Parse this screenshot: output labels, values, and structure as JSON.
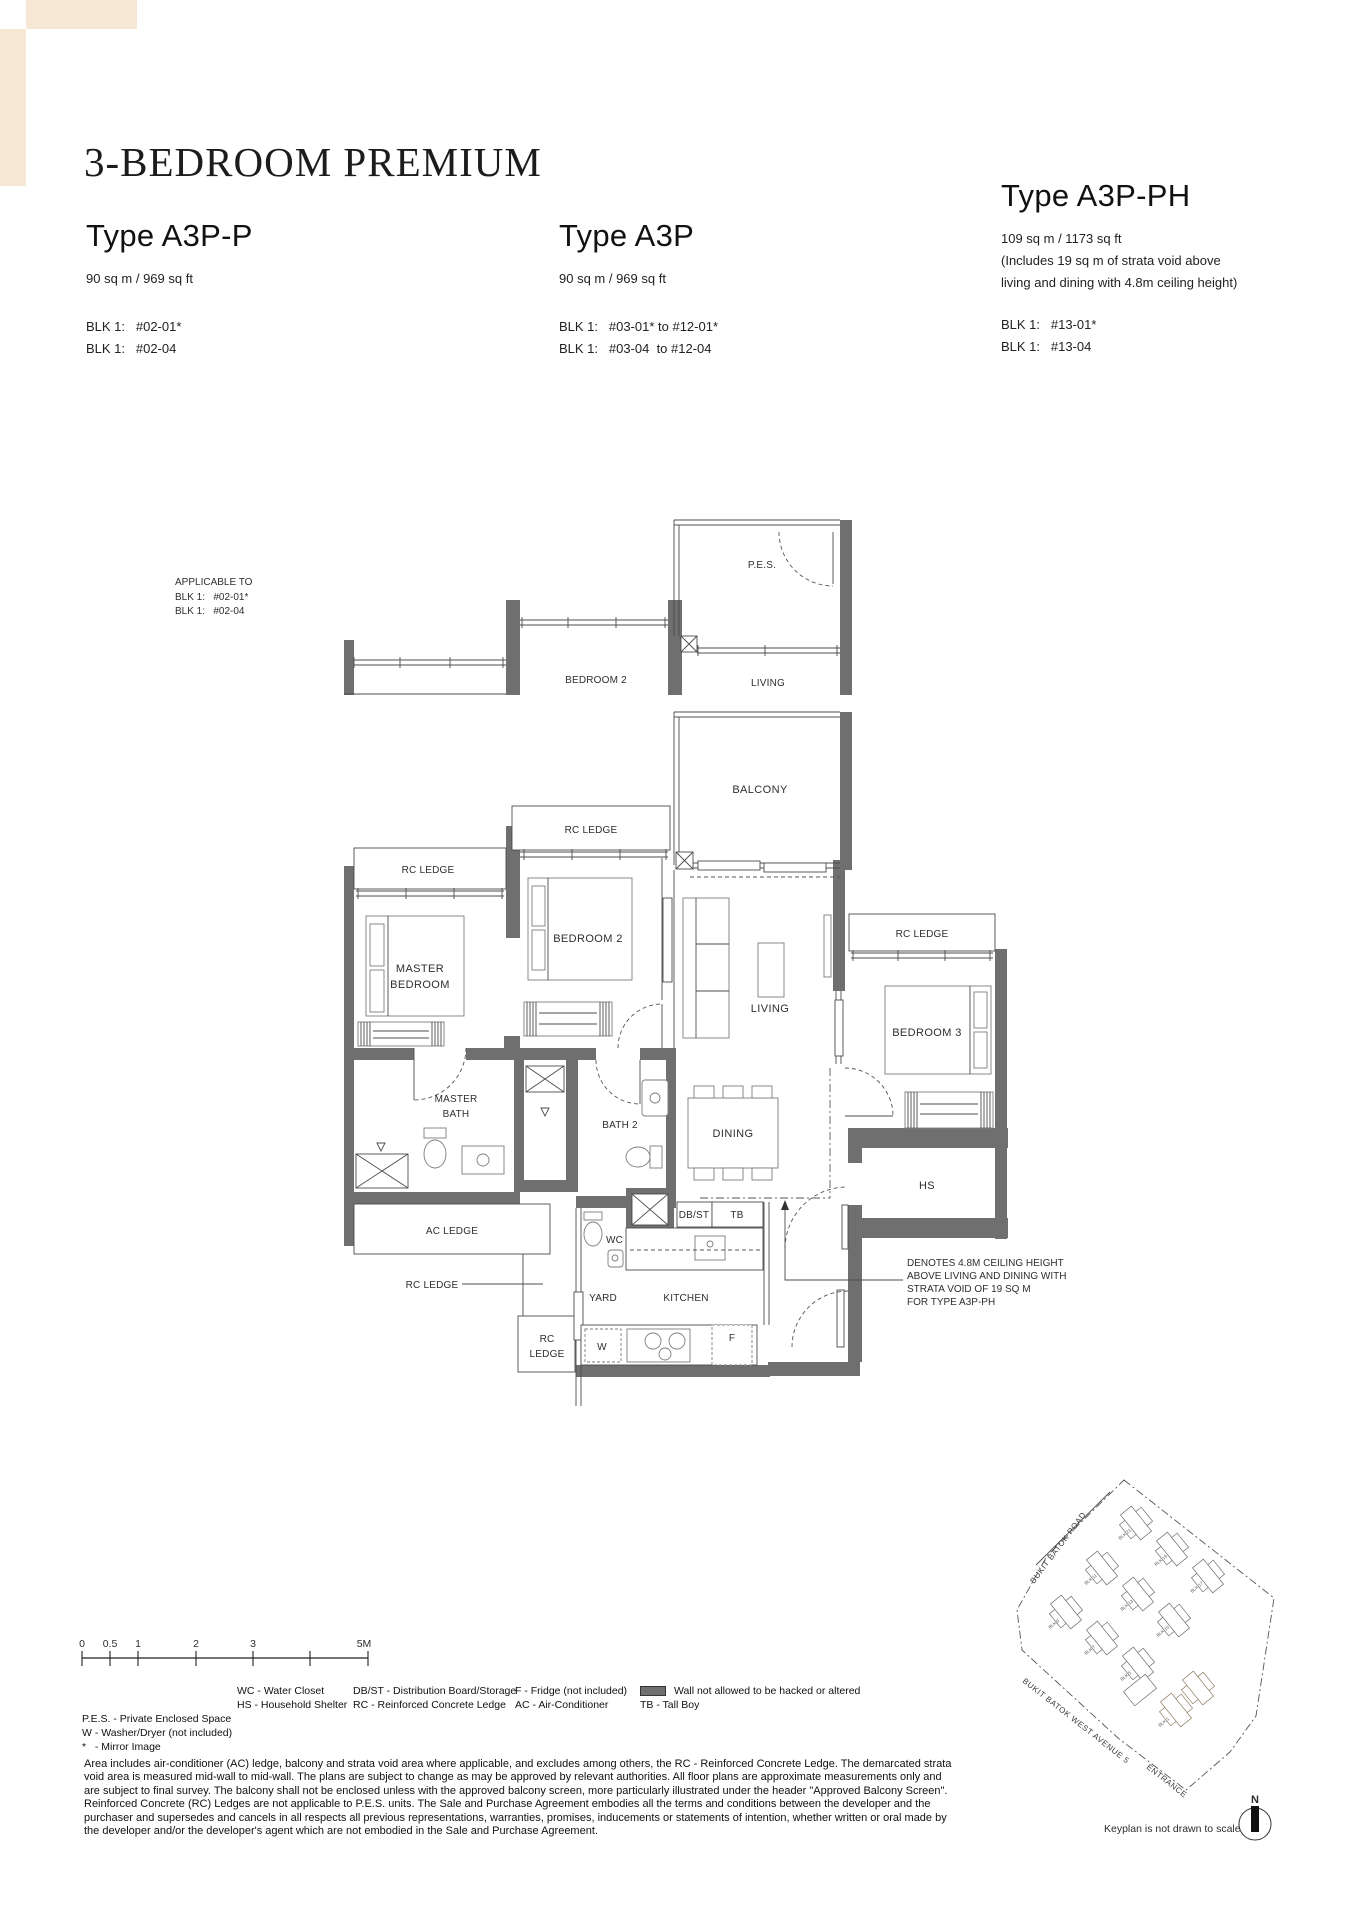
{
  "header": {
    "title": "3-BEDROOM PREMIUM"
  },
  "decor": {
    "beige": "#f5e7d4"
  },
  "types": [
    {
      "name": "Type A3P-P",
      "area": "90 sq m / 969 sq ft",
      "note_lines": [],
      "units": [
        "BLK 1:   #02-01*",
        "BLK 1:   #02-04"
      ]
    },
    {
      "name": "Type A3P",
      "area": "90 sq m / 969 sq ft",
      "note_lines": [],
      "units": [
        "BLK 1:   #03-01* to #12-01*",
        "BLK 1:   #03-04  to #12-04"
      ]
    },
    {
      "name": "Type A3P-PH",
      "area": "109 sq m / 1173 sq ft",
      "note_lines": [
        "(Includes 19 sq m of strata void above",
        "living and dining with 4.8m ceiling height)"
      ],
      "units": [
        "BLK 1:   #13-01*",
        "BLK 1:   #13-04"
      ]
    }
  ],
  "plan": {
    "applicable_note": [
      "APPLICABLE TO",
      "BLK 1:   #02-01*",
      "BLK 1:   #02-04"
    ],
    "labels": {
      "pes": "P.E.S.",
      "living": "LIVING",
      "bedroom2": "BEDROOM 2",
      "balcony": "BALCONY",
      "rc_ledge": "RC LEDGE",
      "rc_box_1": "RC",
      "rc_box_2": "LEDGE",
      "master_1": "MASTER",
      "master_2": "BEDROOM",
      "bedroom3": "BEDROOM 3",
      "dining": "DINING",
      "mbath_1": "MASTER",
      "mbath_2": "BATH",
      "bath2": "BATH 2",
      "hs": "HS",
      "ac_ledge": "AC LEDGE",
      "wc": "WC",
      "dbst": "DB/ST",
      "tb": "TB",
      "yard": "YARD",
      "kitchen": "KITCHEN",
      "w": "W",
      "f": "F"
    },
    "denote_note": [
      "DENOTES 4.8M CEILING HEIGHT",
      "ABOVE LIVING AND DINING WITH",
      "STRATA VOID OF 19 SQ M",
      "FOR TYPE A3P-PH"
    ]
  },
  "scalebar": {
    "labels": [
      "0",
      "0.5",
      "1",
      "2",
      "3",
      "5M"
    ]
  },
  "legend": {
    "col1": [
      "P.E.S. - Private Enclosed Space",
      "W - Washer/Dryer (not included)",
      "*   - Mirror Image"
    ],
    "col2": [
      "WC - Water Closet",
      "HS - Household Shelter"
    ],
    "col3": [
      "DB/ST - Distribution Board/Storage",
      "RC - Reinforced Concrete Ledge"
    ],
    "col4": [
      "F - Fridge (not included)",
      "AC - Air-Conditioner"
    ],
    "wall_item": "Wall not allowed to be hacked or altered",
    "tb_item": "TB - Tall Boy",
    "wall_color": "#6f6f6f"
  },
  "disclaimer_lines": [
    "Area includes air-conditioner (AC) ledge, balcony and strata void area where applicable, and excludes among others, the RC - Reinforced Concrete Ledge. The demarcated strata",
    "void area is measured mid-wall to mid-wall. The plans are subject to change as may be approved by relevant authorities. All floor plans are approximate measurements only and",
    "are subject to final survey. The balcony shall not be enclosed unless with the approved balcony screen, more particularly illustrated under the header \"Approved Balcony Screen\".",
    "Reinforced Concrete (RC) Ledges are not applicable to P.E.S. units. The Sale and Purchase Agreement embodies all the terms and conditions between the developer and the",
    "purchaser and supersedes and cancels in all respects all previous representations, warranties, promises, inducements or statements of intention, whether written or oral made by",
    "the developer and/or the developer's agent which are not embodied in the Sale and Purchase Agreement."
  ],
  "keyplan": {
    "road1": "BUKIT BATOK ROAD",
    "road2": "BUKIT BATOK WEST AVENUE 5",
    "entrance": "ENTRANCE",
    "caption": "Keyplan is not drawn to scale",
    "compass": "N",
    "blocks": [
      "BLK 21",
      "BLK 19",
      "BLK 17",
      "BLK 11",
      "BLK 13",
      "BLK 15",
      "BLK 9",
      "BLK 7",
      "BLK 5",
      "BLK 1"
    ],
    "highlight_color": "#eedcc2"
  }
}
